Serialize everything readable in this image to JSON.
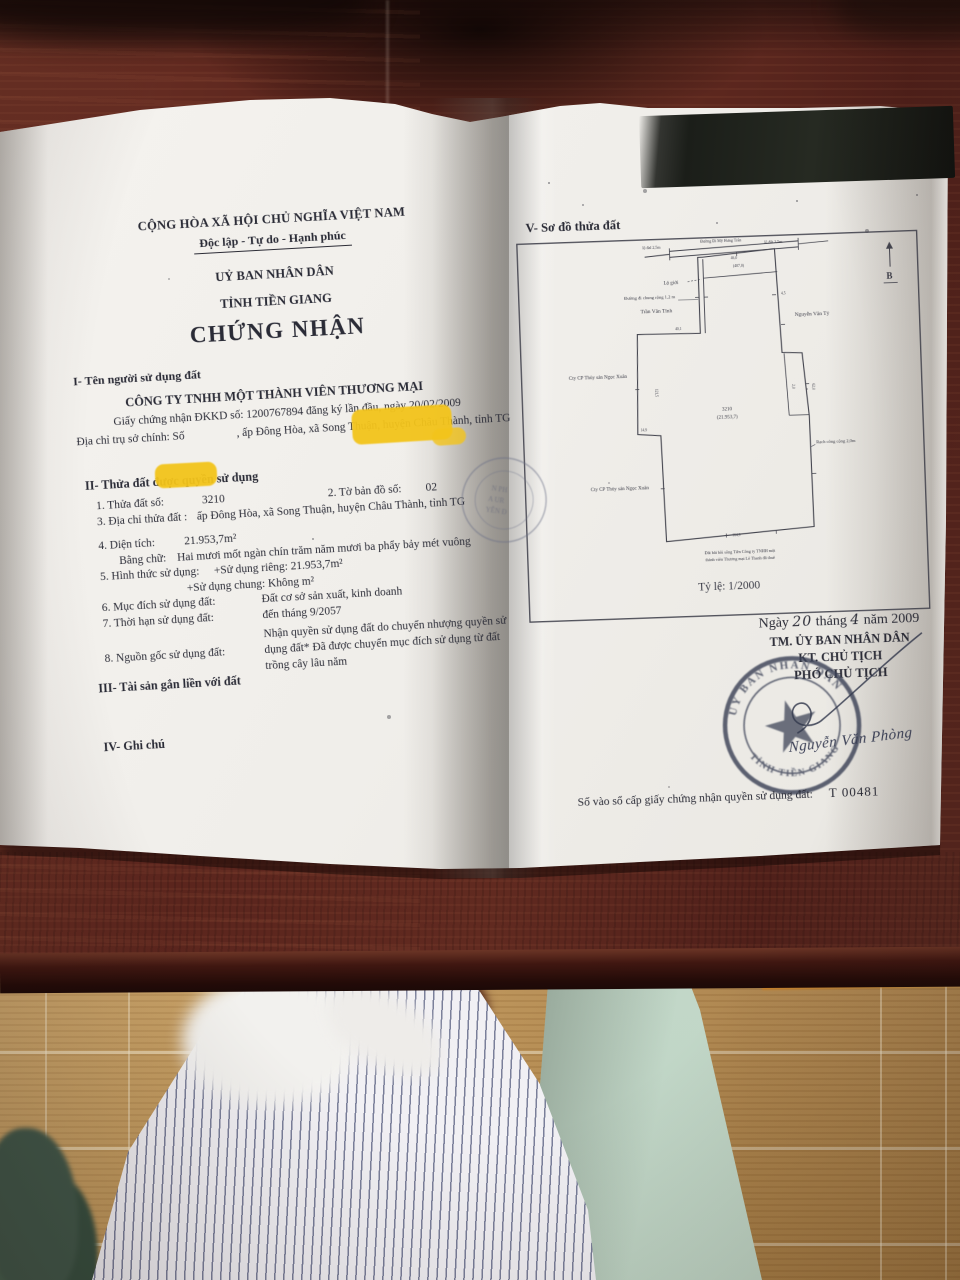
{
  "page_left": {
    "national_title": "CỘNG HÒA XÃ HỘI CHỦ NGHĨA VIỆT NAM",
    "motto": "Độc lập - Tự do - Hạnh phúc",
    "issuer_line1": "UỶ BAN NHÂN DÂN",
    "issuer_line2": "TỈNH TIỀN GIANG",
    "certificate_title": "CHỨNG NHẬN",
    "section1_heading": "I- Tên người sử dụng đất",
    "company_name": "CÔNG TY TNHH MỘT THÀNH VIÊN THƯƠNG MẠI",
    "business_registration": "Giấy chứng nhận ĐKKD số: 1200767894 đăng ký lần đầu, ngày 20/02/2009",
    "hq_address_prefix": "Địa chỉ trụ sở chính: Số",
    "hq_address_suffix": ", ấp Đông Hòa, xã Song Thuận, huyện Châu Thành, tỉnh TG",
    "section2_heading": "II- Thửa đất được quyền sử dụng",
    "parcel_no_label": "1. Thửa đất số:",
    "parcel_no": "3210",
    "map_sheet_label": "2. Tờ bản đồ số:",
    "map_sheet": "02",
    "parcel_address_label": "3. Địa chỉ thửa đất :",
    "parcel_address": "ấp Đông Hòa, xã Song Thuận, huyện Châu Thành, tỉnh TG",
    "area_label": "4. Diện tích:",
    "area": "21.953,7m²",
    "area_words_label": "Bằng chữ:",
    "area_words": "Hai mươi mốt ngàn chín trăm năm mươi ba phẩy bảy mét vuông",
    "use_form_label": "5. Hình thức sử dụng:",
    "use_private": "+Sử dụng riêng: 21.953,7m²",
    "use_common": "+Sử dụng chung: Không m²",
    "purpose_label": "6. Mục đích sử dụng đất:",
    "purpose": "Đất cơ sở sản xuất, kinh doanh",
    "term_label": "7. Thời hạn sử dụng đất:",
    "term": "đến tháng 9/2057",
    "origin_label": "8. Nguồn gốc sử dụng đất:",
    "origin_line1": "Nhận quyền sử dụng đất do chuyển nhượng quyền sử",
    "origin_line2": "dụng đất* Đã được chuyển mục đích sử dụng từ đất",
    "origin_line3": "trồng cây lâu năm",
    "section3_heading": "III- Tài sản gắn liền với đất",
    "section4_heading": "IV- Ghi chú"
  },
  "page_right": {
    "section5_heading": "V- Sơ đồ thửa đất",
    "map": {
      "scale": "Tỷ lệ: 1/2000",
      "north": "B",
      "road_label_left": "lộ đal 2,5m",
      "road_label_center": "Đường Đi Mỹ Hưng Trân",
      "road_label_right": "lộ đất 2,5m",
      "lo_gioi": "Lộ giới",
      "path_label": "Đường đi chung rộng 1,2 m",
      "neighbor_left": "Trần Văn Tính",
      "neighbor_right": "Nguyễn Văn Tỷ",
      "company_label_1": "Cty CP Thủy sản Ngọc Xuân",
      "company_label_2": "Cty CP Thủy sản Ngọc Xuân",
      "canal_label": "Rạch công cộng 2,0m",
      "strip_area": "(407,0)",
      "parcel_number": "3210",
      "parcel_area": "(21.953,7)",
      "note_line1": "Đất bãi bồi sông Tiền Công ty TNHH một",
      "note_line2": "thành viên Thương mại Lê Thanh đã thuê",
      "dims": [
        "40,1",
        "62,0",
        "121,5",
        "164,9",
        "14,9",
        "46,0",
        "4,5",
        "2,0"
      ]
    },
    "date_prefix": "Ngày",
    "date_day": "20",
    "date_month_word": "tháng",
    "date_month": "4",
    "date_year_word": "năm 2009",
    "sig_line1": "TM. ỦY BAN NHÂN DÂN",
    "sig_line2": "KT. CHỦ TỊCH",
    "sig_line3": "PHÓ CHỦ TỊCH",
    "signer_name": "Nguyễn Văn Phòng",
    "stamp_text_top": "ỦY BAN NHÂN DÂN",
    "stamp_text_bottom": "TỈNH TIỀN GIANG",
    "registry_label": "Số vào sổ cấp giấy chứng nhận quyền sử dụng đất:",
    "registry_number": "T 00481"
  },
  "colors": {
    "highlight": "#f3c41b",
    "redaction": "#1b1e19",
    "stamp_ink": "#3c4257",
    "paper": "#f3f1ec",
    "desk_wood": "#5b251d",
    "floor_wood": "#c59d62",
    "shirt_stripe": "#7a7f9a",
    "mint_fabric": "#cbded1"
  }
}
